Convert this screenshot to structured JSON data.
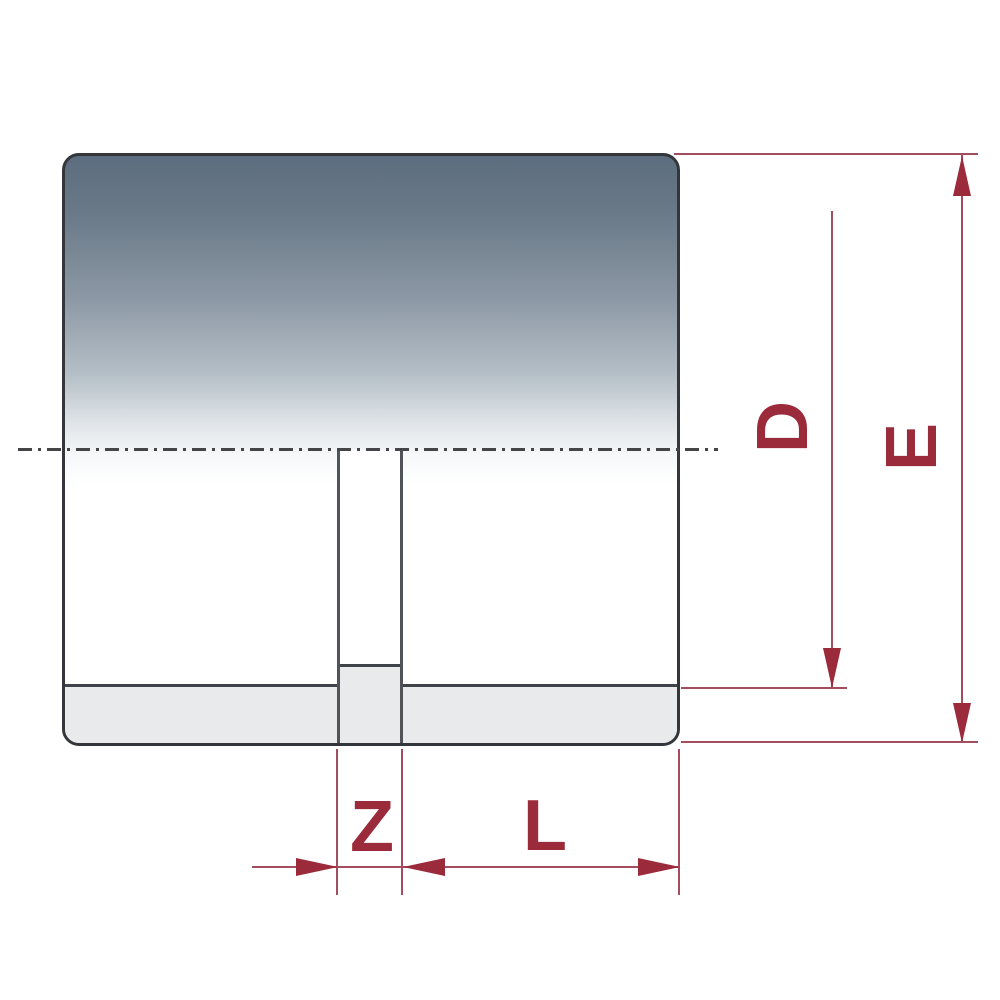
{
  "diagram": {
    "type": "technical-dimension-drawing",
    "labels": {
      "d": "D",
      "e": "E",
      "z": "Z",
      "l": "L"
    },
    "colors": {
      "dimension_line": "#a34d5e",
      "dimension_arrow_and_label": "#9b2a3a",
      "body_outline": "#33373c",
      "body_gradient_top": "#5c6d7f",
      "body_gradient_bottom": "#ffffff",
      "inner_wall_fill": "#e9eaec",
      "centerline": "#454547",
      "background": "#ffffff"
    }
  }
}
